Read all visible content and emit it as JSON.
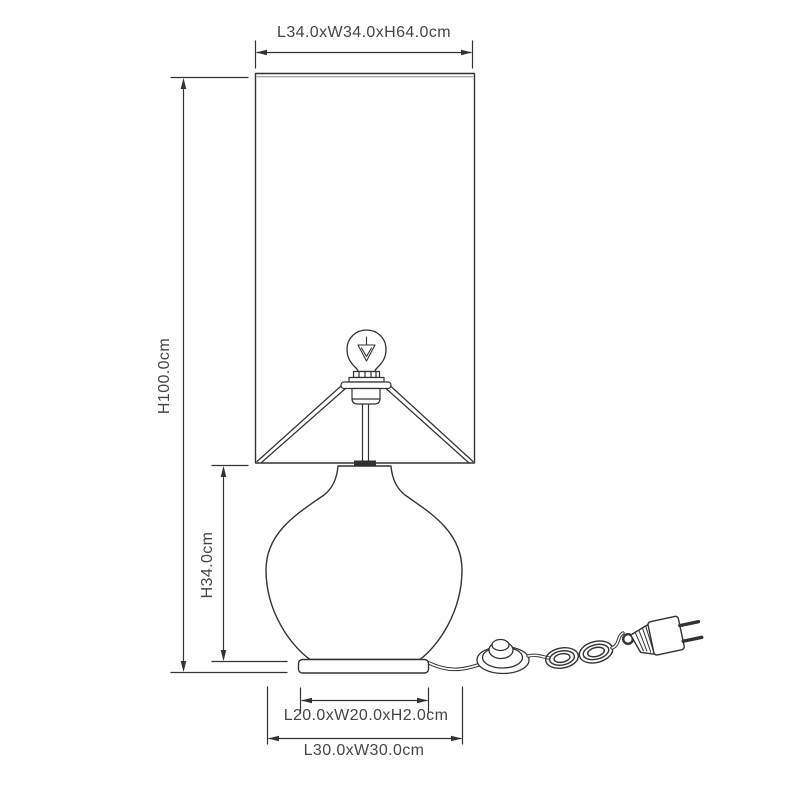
{
  "diagram": {
    "type": "technical-line-drawing",
    "labels": {
      "shade_dimensions": "L34.0xW34.0xH64.0cm",
      "total_height": "H100.0cm",
      "base_height": "H34.0cm",
      "base_plate_dimensions": "L20.0xW20.0xH2.0cm",
      "base_footprint": "L30.0xW30.0cm"
    },
    "parts": [
      "lamp-shade",
      "light-bulb",
      "bulb-filament",
      "lamp-socket",
      "shade-frame",
      "lamp-stem",
      "glass-base",
      "base-plate",
      "power-cord",
      "foot-switch",
      "cord-coil",
      "euro-plug"
    ],
    "colors": {
      "line": "#333333",
      "line_secondary": "#8a8a8a",
      "text": "#454545",
      "background": "#ffffff"
    }
  }
}
